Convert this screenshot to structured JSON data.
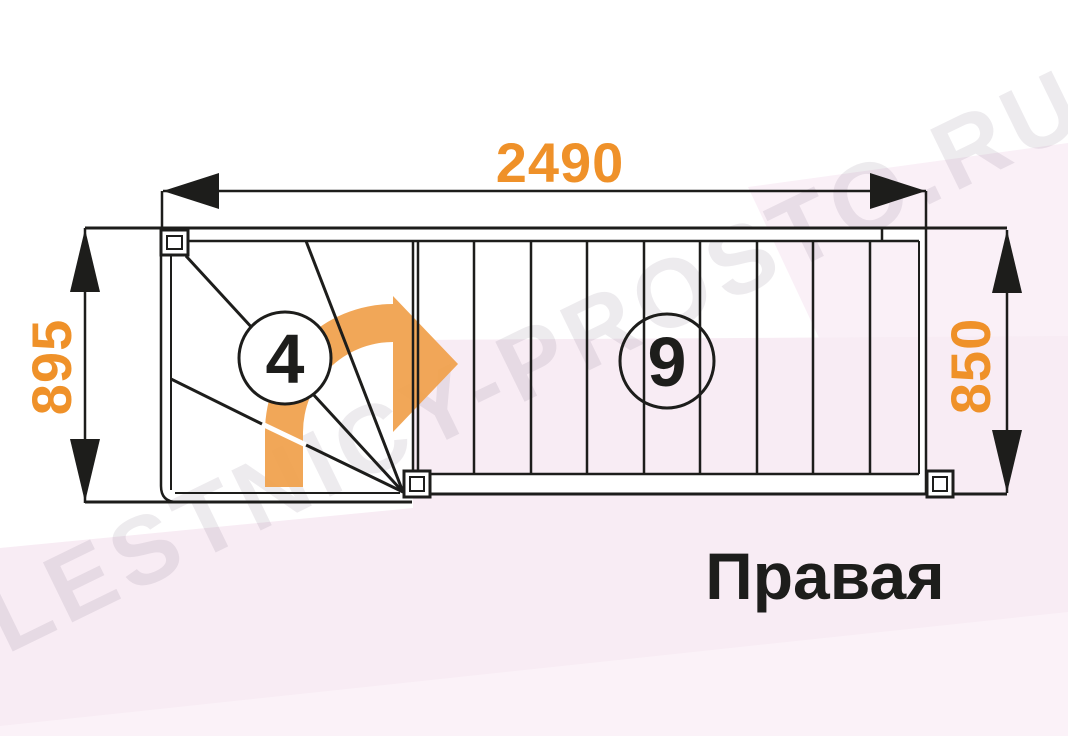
{
  "diagram": {
    "type_label": "Правая",
    "watermark_text": "LESTNICY-PROSTO.RU",
    "dimensions": {
      "total_length": "2490",
      "winder_depth": "895",
      "flight_width": "850"
    },
    "steps": {
      "winder_count": "4",
      "straight_count": "9"
    },
    "icons": {
      "direction_arrow": "curved-right-turn-arrow"
    },
    "colors": {
      "accent_orange": "#ef9129",
      "line_black": "#1d1d1b",
      "background_pink": "#f8ecf4",
      "background_pink_light": "#faf0f7"
    }
  }
}
